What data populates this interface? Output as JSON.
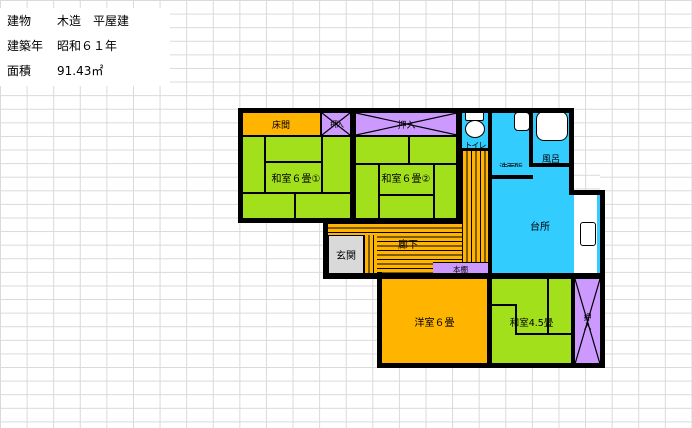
{
  "info": {
    "rows": [
      {
        "label": "建物",
        "value": "木造　平屋建"
      },
      {
        "label": "建築年",
        "value": "昭和６１年"
      },
      {
        "label": "面積",
        "value": "91.43㎡"
      }
    ]
  },
  "plan": {
    "labels": {
      "tokonoma": "床間",
      "closet_small": "押入",
      "closet_top": "押入",
      "closet_right": "押入",
      "washitsu1": "和室６畳①",
      "washitsu2": "和室６畳②",
      "washitsu45": "和室4.5畳",
      "yoshitsu": "洋室６畳",
      "toilet": "トイレ",
      "washroom": "洗面所",
      "bath": "風呂",
      "kitchen": "台所",
      "entrance": "玄関",
      "hallway": "廊下",
      "bookshelf": "本棚"
    },
    "colors": {
      "tatami_green": "#a3e01c",
      "wood_orange": "#ffb400",
      "closet_purple": "#cc99ff",
      "water_cyan": "#33ccff",
      "entrance_gray": "#d9d9d9",
      "wall_black": "#000000",
      "grid_line": "#d9d9d9"
    }
  }
}
